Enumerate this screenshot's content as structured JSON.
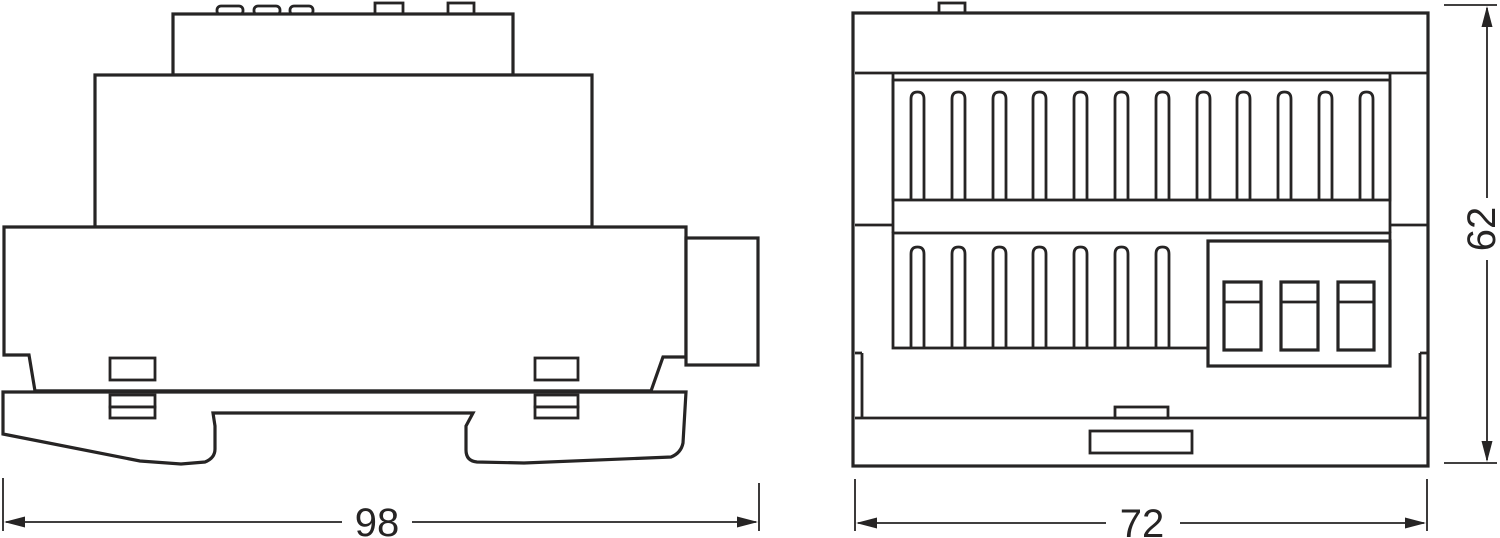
{
  "drawing": {
    "background_color": "#ffffff",
    "line_color": "#262424",
    "dimensions": {
      "side_width": {
        "value": "98"
      },
      "front_width": {
        "value": "72"
      },
      "height": {
        "value": "62"
      }
    }
  }
}
